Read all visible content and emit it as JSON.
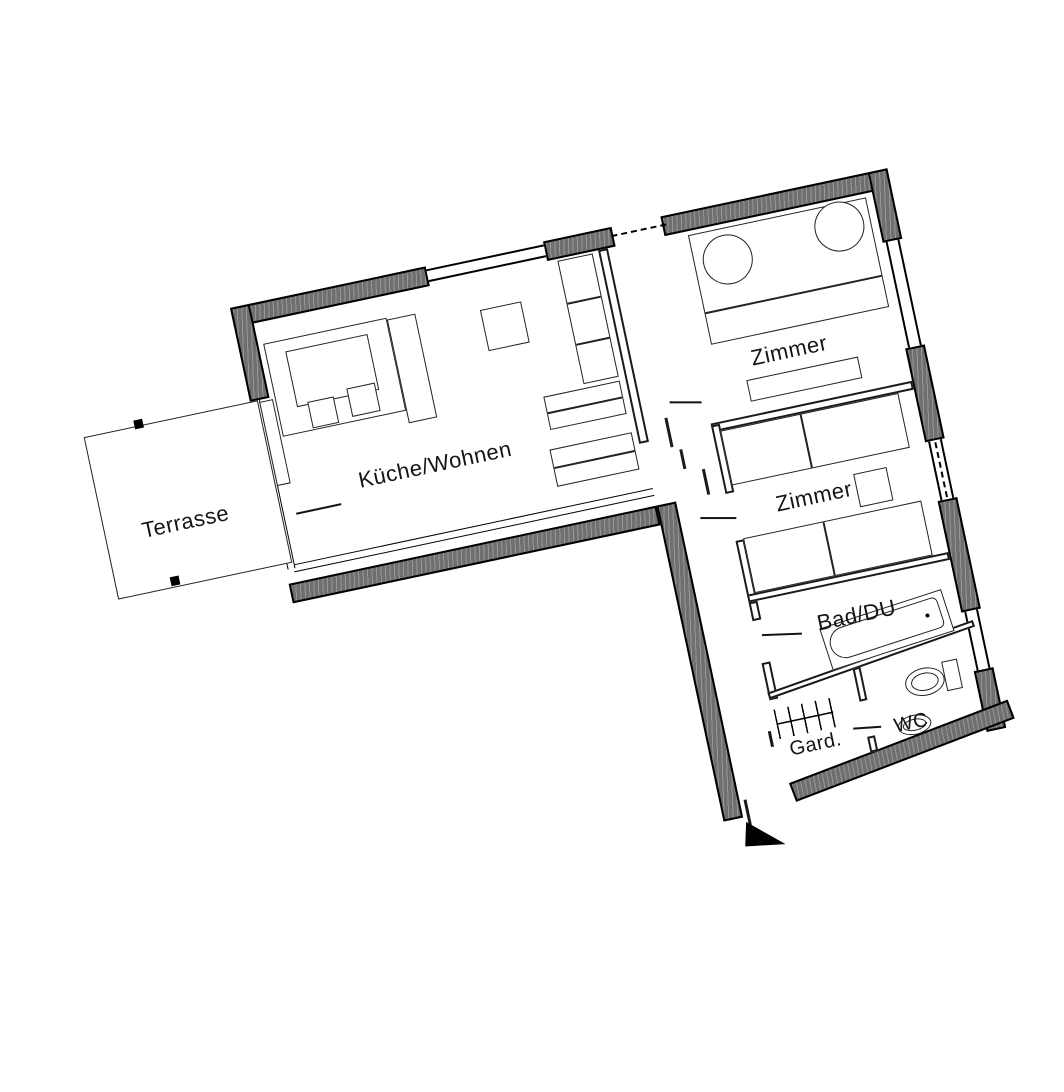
{
  "rooms": {
    "terrasse": "Terrasse",
    "kueche": "Küche/Wohnen",
    "zimmer1": "Zimmer",
    "zimmer2": "Zimmer",
    "bad": "Bad/DU",
    "gard": "Gard.",
    "wc": "WC"
  },
  "colors": {
    "wall_fill": "#6f6f6f",
    "line": "#000000",
    "background": "#ffffff"
  },
  "icons": {
    "entrance_arrow": "filled black triangle marking the apartment entrance"
  }
}
